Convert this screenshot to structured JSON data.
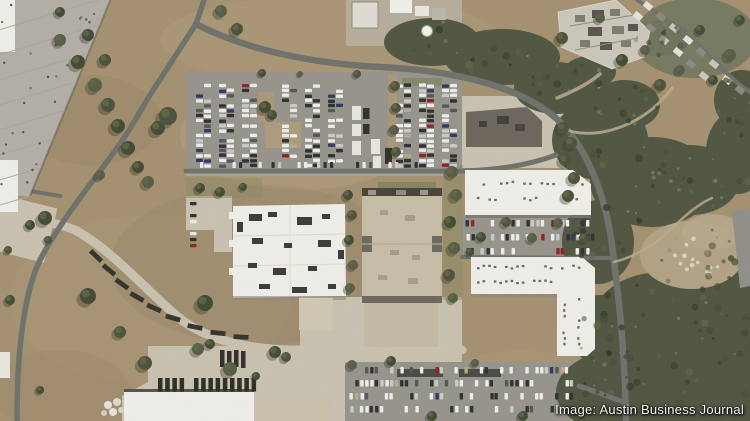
{
  "credit": {
    "text": "Image: Austin Business Journal",
    "color": "#f4f4f2"
  },
  "colors": {
    "field": "#a3906f",
    "field_light": "#b6a384",
    "field_dark": "#8e7c60",
    "woods": "#4f5540",
    "woods_dark": "#39402d",
    "woods_light": "#6e7657",
    "asphalt_road": "#6e706a",
    "concrete": "#c9c1af",
    "parking": "#96938b",
    "roof_white": "#efede7",
    "roof_gray": "#b2aea6",
    "roof_tan": "#c6bca6",
    "roof_dark": "#6b655b",
    "hvac_dark": "#3a3b36",
    "trailer_dark": "#33332c",
    "car_palette": [
      "#ececea",
      "#c9c9c6",
      "#2e2f31",
      "#52555a",
      "#8f2222",
      "#2b3a5e",
      "#b5a98f"
    ]
  }
}
